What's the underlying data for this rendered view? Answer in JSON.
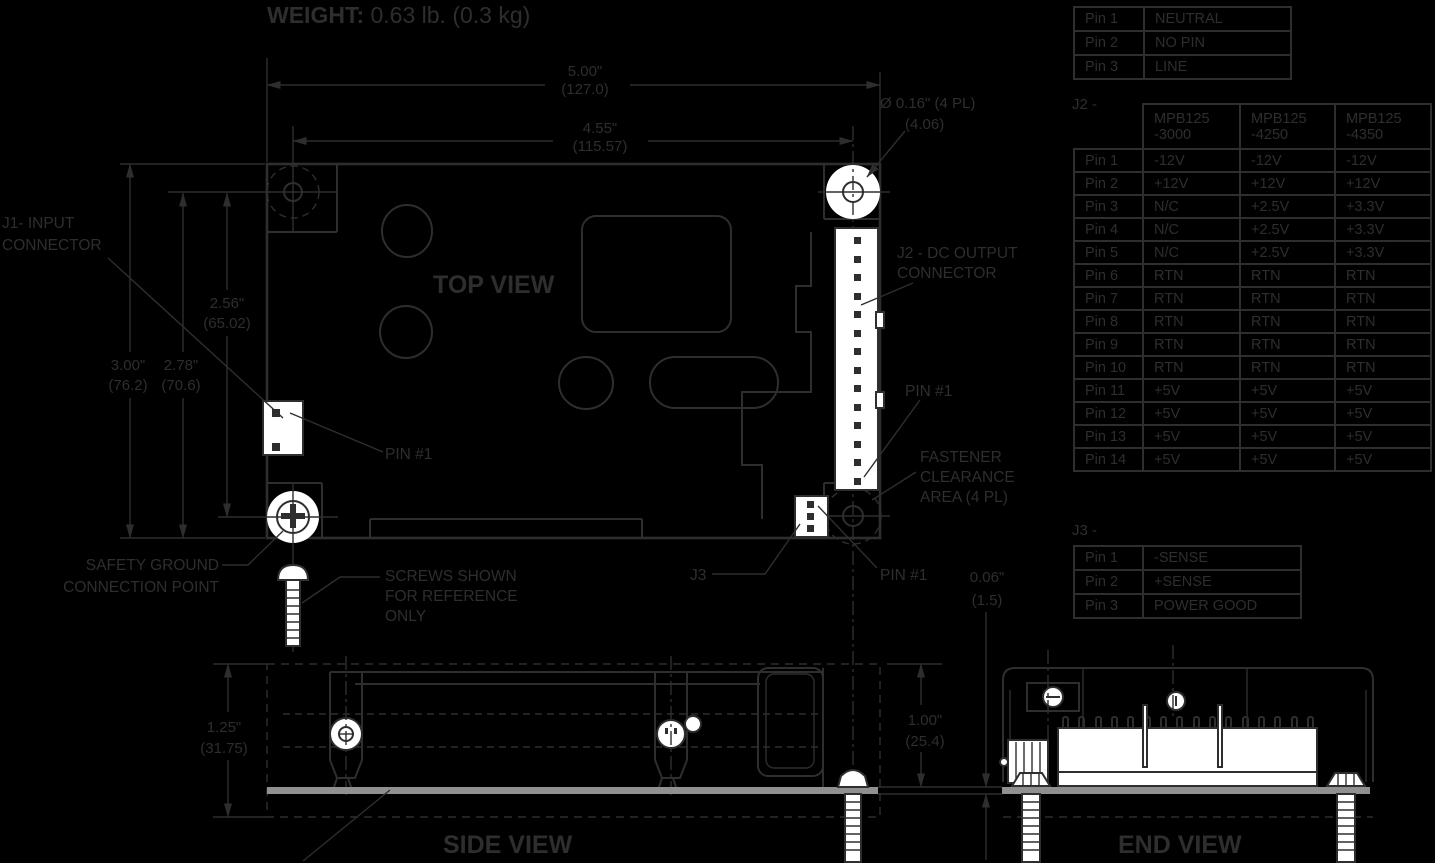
{
  "page": {
    "background": "#000000",
    "line_color": "#2e2e2e",
    "white_fill": "#ffffff",
    "pcb_gray": "#909090"
  },
  "weight": {
    "label": "WEIGHT:",
    "value": "0.63 lb. (0.3 kg)"
  },
  "views": {
    "top": "TOP VIEW",
    "side": "SIDE VIEW",
    "end": "END VIEW"
  },
  "dimensions": {
    "board_width_in": "5.00\"",
    "board_width_mm": "(127.0)",
    "hole_span_in": "4.55\"",
    "hole_span_mm": "(115.57)",
    "hole_dia": "Ø 0.16\" (4 PL)",
    "hole_dia_mm": "(4.06)",
    "board_height_in": "3.00\"",
    "board_height_mm": "(76.2)",
    "edge_to_hole_in": "2.78\"",
    "edge_to_hole_mm": "(70.6)",
    "hole_span_v_in": "2.56\"",
    "hole_span_v_mm": "(65.02)",
    "pcb_thickness_in": "0.06\"",
    "pcb_thickness_mm": "(1.5)",
    "side_height_in": "1.25\"",
    "side_height_mm": "(31.75)",
    "end_height_in": "1.00\"",
    "end_height_mm": "(25.4)"
  },
  "callouts": {
    "j1_line1": "J1- INPUT",
    "j1_line2": "CONNECTOR",
    "j2_line1": "J2 - DC OUTPUT",
    "j2_line2": "CONNECTOR",
    "pin1": "PIN #1",
    "fastener_line1": "FASTENER",
    "fastener_line2": "CLEARANCE",
    "fastener_line3": "AREA (4 PL)",
    "safety_line1": "SAFETY GROUND",
    "safety_line2": "CONNECTION POINT",
    "screws_line1": "SCREWS SHOWN",
    "screws_line2": "FOR REFERENCE",
    "screws_line3": "ONLY",
    "j3": "J3"
  },
  "tables": {
    "ac_input": {
      "rows": [
        {
          "pin": "Pin 1",
          "value": "NEUTRAL"
        },
        {
          "pin": "Pin 2",
          "value": "NO PIN"
        },
        {
          "pin": "Pin 3",
          "value": "LINE"
        }
      ]
    },
    "j2": {
      "label": "J2 -",
      "headers": [
        {
          "line1": "MPB125",
          "line2": "-3000"
        },
        {
          "line1": "MPB125",
          "line2": "-4250"
        },
        {
          "line1": "MPB125",
          "line2": "-4350"
        }
      ],
      "rows": [
        {
          "pin": "Pin 1",
          "values": [
            "-12V",
            "-12V",
            "-12V"
          ]
        },
        {
          "pin": "Pin 2",
          "values": [
            "+12V",
            "+12V",
            "+12V"
          ]
        },
        {
          "pin": "Pin 3",
          "values": [
            "N/C",
            "+2.5V",
            "+3.3V"
          ]
        },
        {
          "pin": "Pin 4",
          "values": [
            "N/C",
            "+2.5V",
            "+3.3V"
          ]
        },
        {
          "pin": "Pin 5",
          "values": [
            "N/C",
            "+2.5V",
            "+3.3V"
          ]
        },
        {
          "pin": "Pin 6",
          "values": [
            "RTN",
            "RTN",
            "RTN"
          ]
        },
        {
          "pin": "Pin 7",
          "values": [
            "RTN",
            "RTN",
            "RTN"
          ]
        },
        {
          "pin": "Pin 8",
          "values": [
            "RTN",
            "RTN",
            "RTN"
          ]
        },
        {
          "pin": "Pin 9",
          "values": [
            "RTN",
            "RTN",
            "RTN"
          ]
        },
        {
          "pin": "Pin 10",
          "values": [
            "RTN",
            "RTN",
            "RTN"
          ]
        },
        {
          "pin": "Pin 11",
          "values": [
            "+5V",
            "+5V",
            "+5V"
          ]
        },
        {
          "pin": "Pin 12",
          "values": [
            "+5V",
            "+5V",
            "+5V"
          ]
        },
        {
          "pin": "Pin 13",
          "values": [
            "+5V",
            "+5V",
            "+5V"
          ]
        },
        {
          "pin": "Pin 14",
          "values": [
            "+5V",
            "+5V",
            "+5V"
          ]
        }
      ]
    },
    "j3": {
      "label": "J3 -",
      "rows": [
        {
          "pin": "Pin 1",
          "value": "-SENSE"
        },
        {
          "pin": "Pin 2",
          "value": "+SENSE"
        },
        {
          "pin": "Pin 3",
          "value": "POWER GOOD"
        }
      ]
    }
  }
}
